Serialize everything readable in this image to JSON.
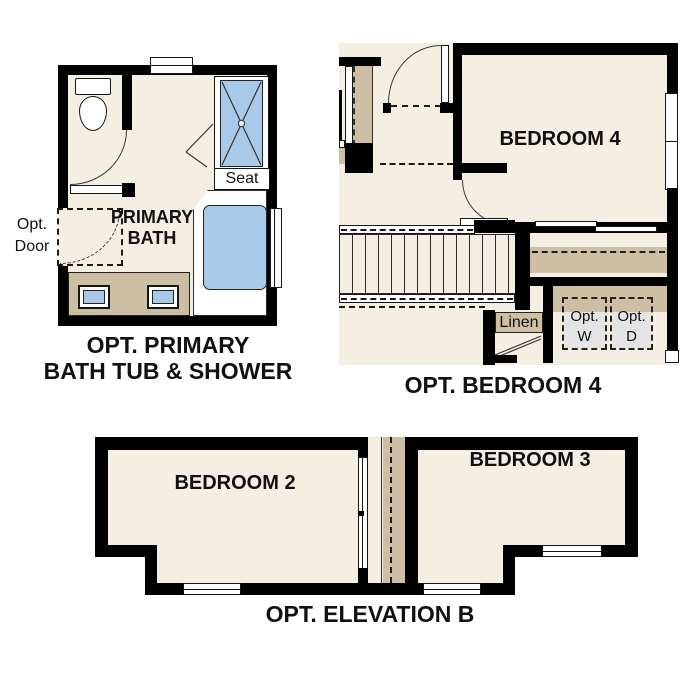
{
  "colors": {
    "background": "#ffffff",
    "wall": "#000000",
    "floor": "#f5eee2",
    "tan": "#ccbfa4",
    "fixture_blue": "#a9c9e9",
    "appliance_gray": "#e4e4e4",
    "text": "#111111"
  },
  "bath_plan": {
    "title_line1": "OPT. PRIMARY",
    "title_line2": "BATH TUB & SHOWER",
    "room_line1": "PRIMARY",
    "room_line2": "BATH",
    "seat": "Seat",
    "opt_door_line1": "Opt.",
    "opt_door_line2": "Door"
  },
  "bedroom4_plan": {
    "title": "OPT. BEDROOM 4",
    "room": "BEDROOM 4",
    "linen": "Linen",
    "washer_line1": "Opt.",
    "washer_line2": "W",
    "dryer_line1": "Opt.",
    "dryer_line2": "D"
  },
  "elevation_plan": {
    "title": "OPT. ELEVATION B",
    "bedroom2": "BEDROOM 2",
    "bedroom3": "BEDROOM 3"
  }
}
